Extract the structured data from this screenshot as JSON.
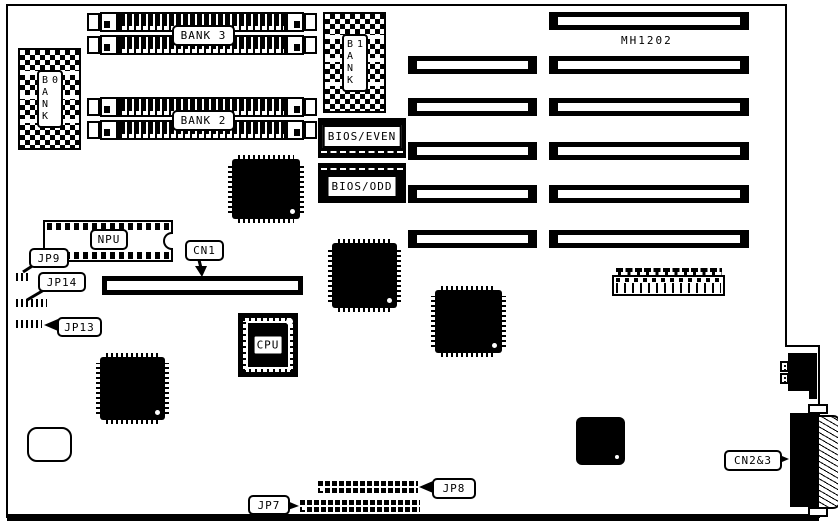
{
  "board": {
    "model": "MH1202"
  },
  "banks": {
    "bank0": "BANK 0",
    "bank1": "BANK 1",
    "bank2": "BANK 2",
    "bank3": "BANK 3"
  },
  "bios": {
    "even": "BIOS/EVEN",
    "odd": "BIOS/ODD"
  },
  "sockets": {
    "cpu": "CPU",
    "npu": "NPU"
  },
  "connectors": {
    "cn1": "CN1",
    "cn2_3": "CN2&3"
  },
  "jumpers": {
    "jp7": "JP7",
    "jp8": "JP8",
    "jp9": "JP9",
    "jp13": "JP13",
    "jp14": "JP14"
  },
  "colors": {
    "ink": "#000000",
    "paper": "#ffffff"
  }
}
